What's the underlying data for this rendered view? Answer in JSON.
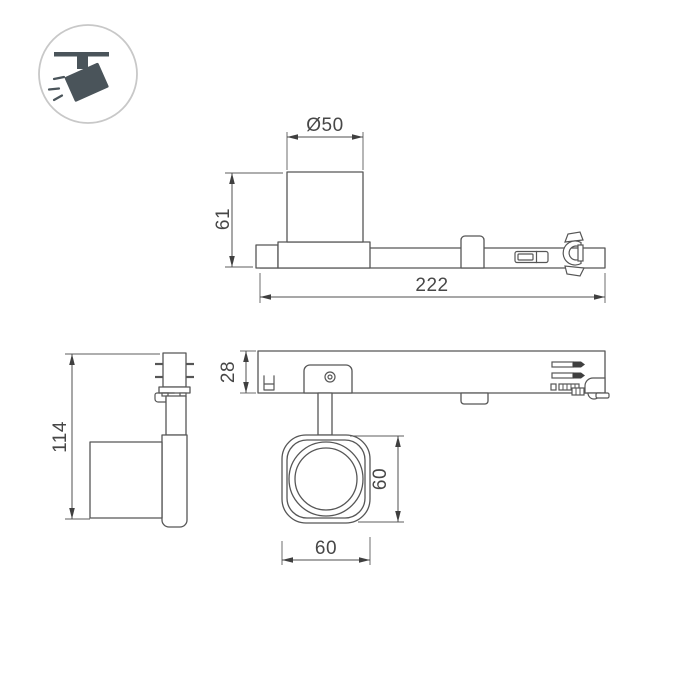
{
  "drawing": {
    "type": "technical-dimension-drawing",
    "subject": "LED track spotlight fixture (three orthographic views plus lens front view)",
    "background_color": "#ffffff",
    "line_color": "#565656",
    "dimension_text_color": "#474747",
    "dimensions": {
      "lens_diameter": "Ø50",
      "head_height_side": "61",
      "total_length": "222",
      "rail_height": "28",
      "fixture_height": "114",
      "head_height_front": "60",
      "head_width_front": "60"
    },
    "icon": {
      "name": "track-spotlight-icon",
      "ring_color": "#c8c8c8",
      "glyph_color": "#4a545a"
    }
  }
}
